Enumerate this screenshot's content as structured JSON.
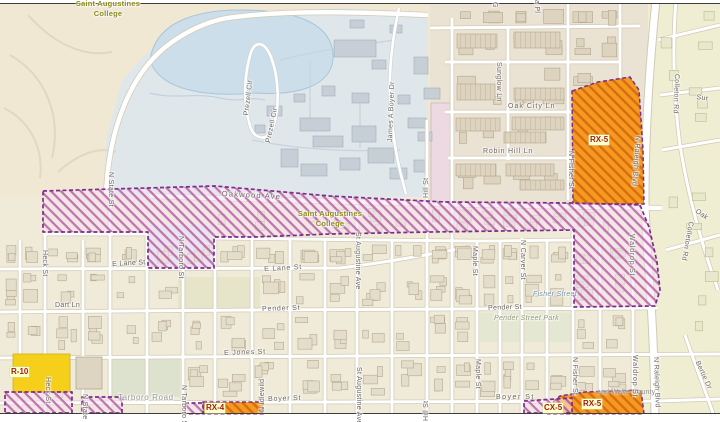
{
  "labels": {
    "attribution": "and Wake County",
    "college": {
      "line1": "Saint Augustines",
      "line2": "College"
    },
    "zones": {
      "rx5": "RX-5",
      "rx4": "RX-4",
      "cx5": "CX-5",
      "r10": "R-10"
    },
    "places": {
      "fisher_street": "Fisher Street",
      "pender_street_park": "Pender Street Park"
    },
    "streets": {
      "oakwood_ave": "Oakwood Ave",
      "oak_city_ln": "Oak City Ln",
      "robin_hill_ln": "Robin Hill Ln",
      "e_lane_st": "E Lane St",
      "pender_st": "Pender St",
      "e_jones_st": "E Jones St",
      "boyer_st": "Boyer St",
      "tarboro_road": "Tarboro Road",
      "dart_ln": "Dart Ln",
      "prezell_cir": "Prezell Cir",
      "james_a_boyer_dr": "James A Boyer Dr",
      "sunglow_ln": "Sunglow Ln",
      "colleton_rd": "Colleton Rd",
      "n_state_st": "N State St",
      "heck_st": "Heck St",
      "n_tarboro_st": "N Tarboro St",
      "n_idlewild": "N Idlewild",
      "st_augustine_ave": "St Augustine Ave",
      "hill_st": "Hill St",
      "maple_st": "Maple St",
      "n_carver_st": "N Carver St",
      "n_fisher_st": "N Fisher St",
      "waldrop_st": "Waldrop St",
      "n_raleigh_blvd": "N Raleigh Blvd",
      "bertie_dr": "Bertie Dr"
    },
    "partials": {
      "sur": "Sur",
      "oak": "Oak",
      "pl": "a Pl",
      "g": "G"
    }
  },
  "colors": {
    "overlay_purple": "#7b2d8b",
    "zone_orange": "#f49b1f",
    "zone_yellow": "#f6cf1b",
    "zone_label_red": "#9e1b1b",
    "campus_blue": "#dfe7eb",
    "water_blue": "#cbdeea"
  }
}
